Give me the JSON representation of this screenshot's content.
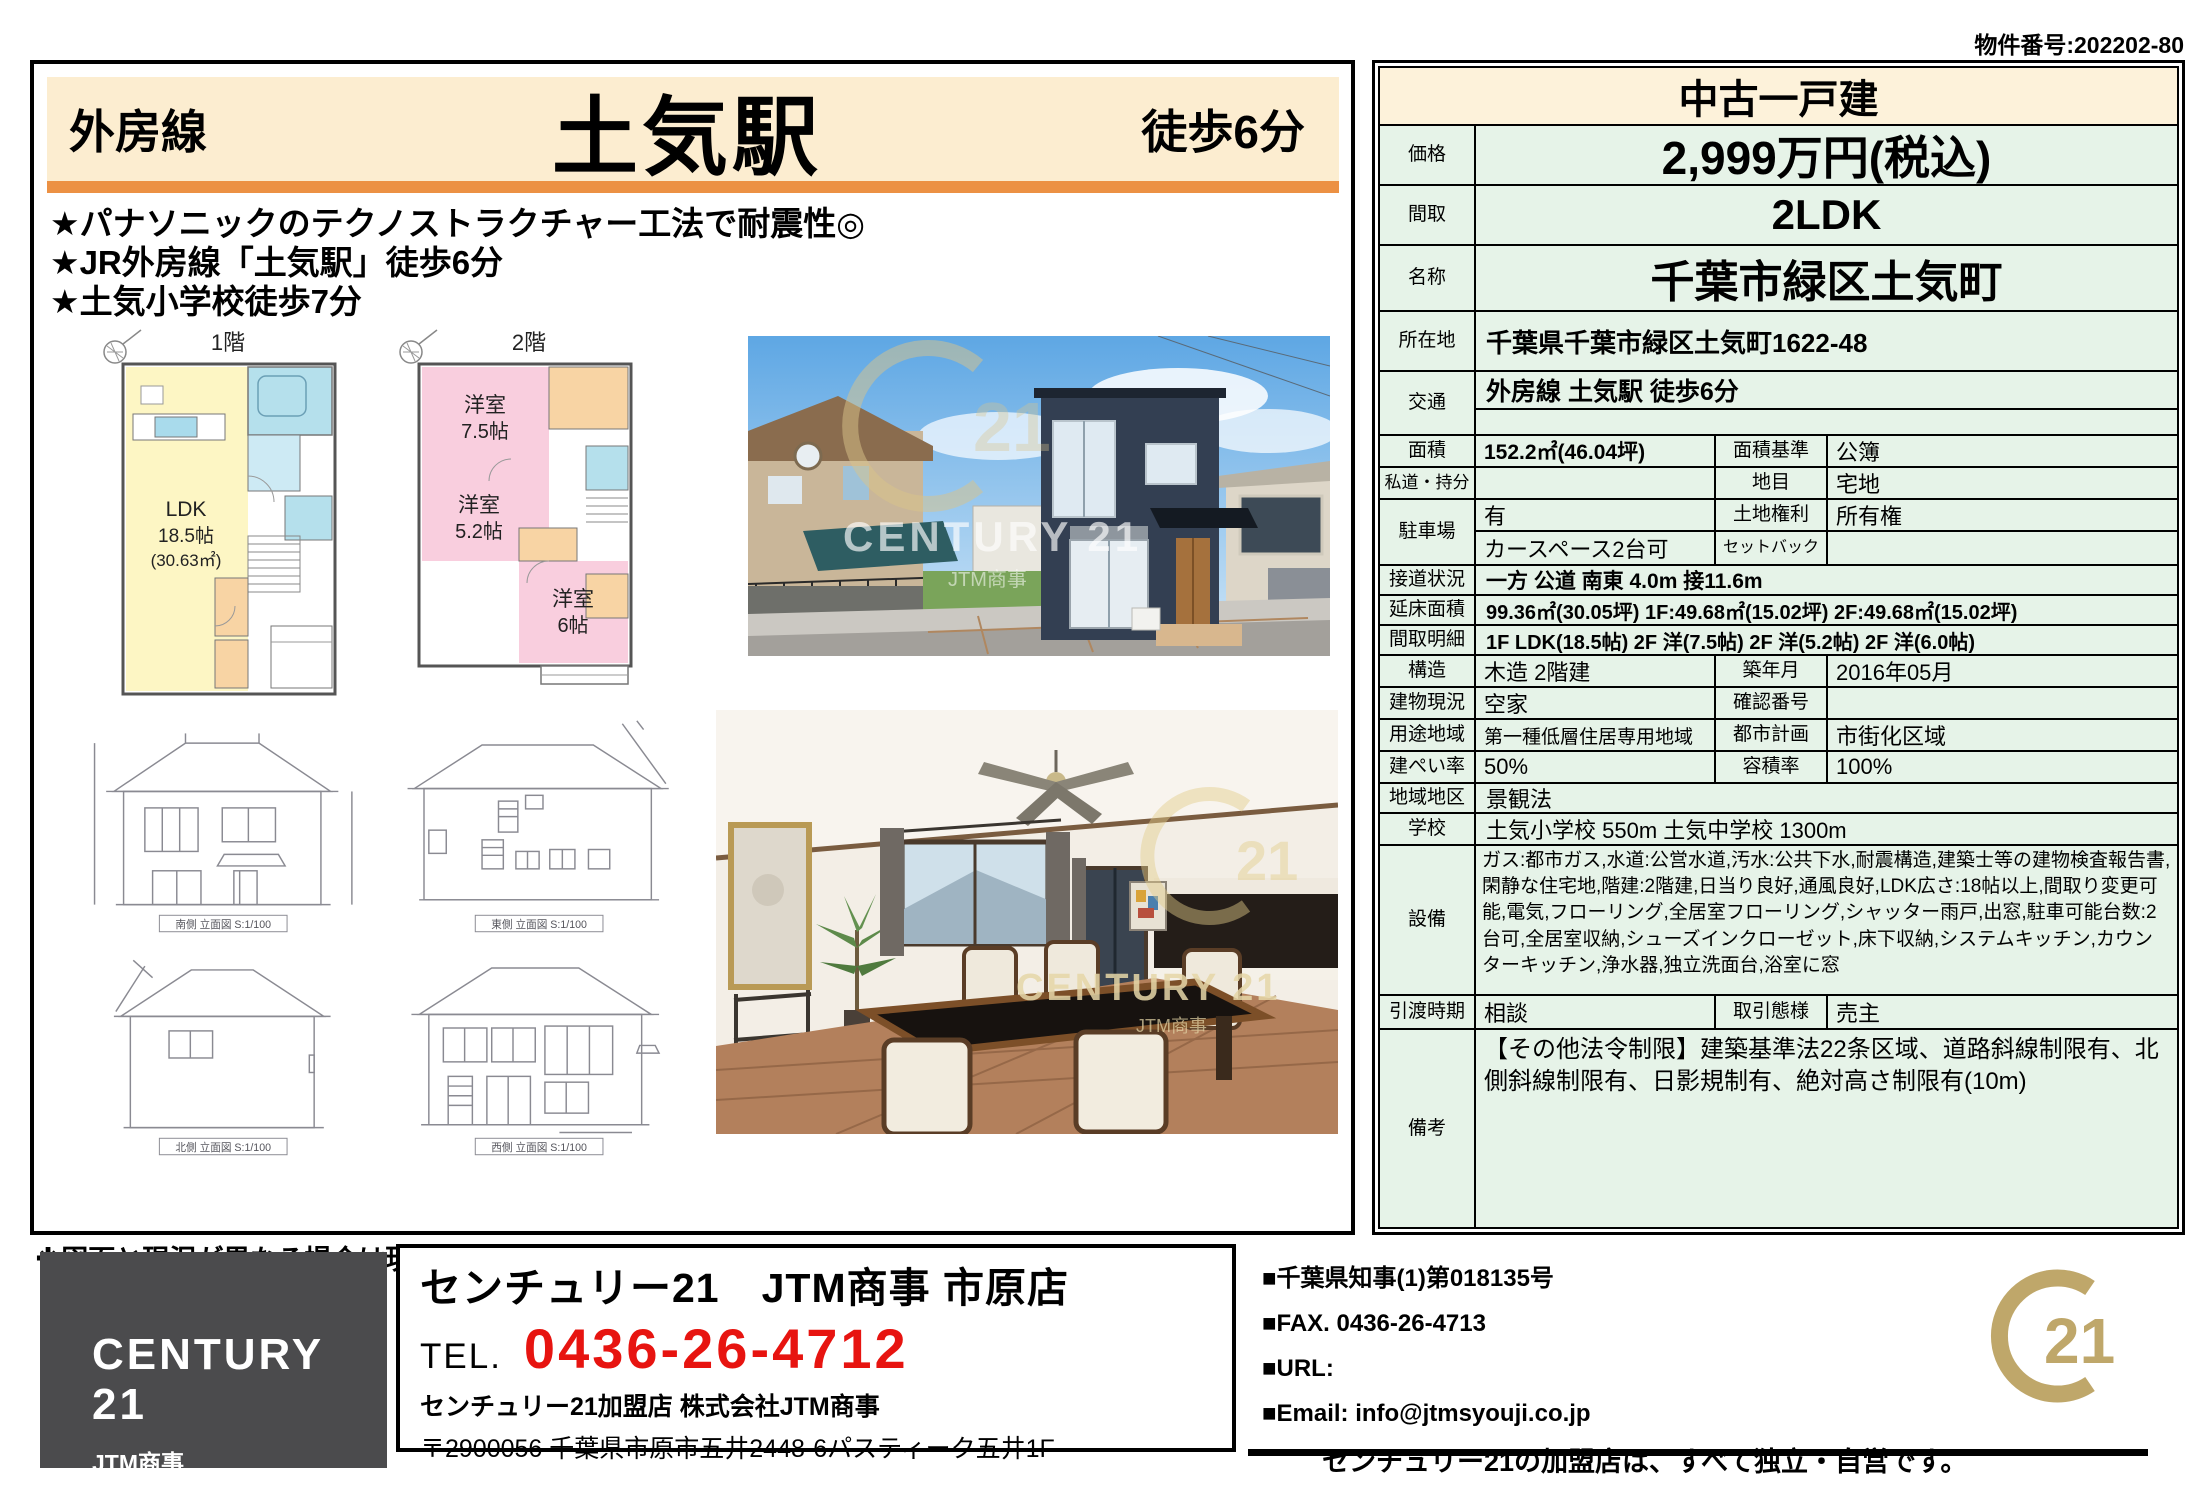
{
  "meta": {
    "property_number": "物件番号:202202-80"
  },
  "header": {
    "line_name": "外房線",
    "station": "土気駅",
    "walk_time": "徒歩6分"
  },
  "highlights": [
    "★パナソニックのテクノストラクチャー工法で耐震性◎",
    "★JR外房線「土気駅」徒歩6分",
    "★土気小学校徒歩7分"
  ],
  "floorplans": {
    "floor1_label": "1階",
    "floor2_label": "2階",
    "ldk_name": "LDK",
    "ldk_size": "18.5帖",
    "ldk_area": "(30.63㎡)",
    "room1_name": "洋室",
    "room1_size": "7.5帖",
    "room2_name": "洋室",
    "room2_size": "5.2帖",
    "room3_name": "洋室",
    "room3_size": "6帖"
  },
  "elevations": {
    "south": "南側 立面図 S:1/100",
    "east": "東側 立面図 S:1/100",
    "north": "北側 立面図 S:1/100",
    "west": "西側 立面図 S:1/100"
  },
  "photos": {
    "watermark": "CENTURY 21",
    "watermark_sub": "JTM商事"
  },
  "spec": {
    "title": "中古一戸建",
    "price": {
      "label": "価格",
      "value": "2,999万円(税込)"
    },
    "madori": {
      "label": "間取",
      "value": "2LDK"
    },
    "name": {
      "label": "名称",
      "value": "千葉市緑区土気町"
    },
    "location": {
      "label": "所在地",
      "value": "千葉県千葉市緑区土気町1622-48"
    },
    "access": {
      "label": "交通",
      "value": "外房線 土気駅 徒歩6分"
    },
    "area": {
      "label": "面積",
      "value": "152.2㎡(46.04坪)",
      "label2": "面積基準",
      "value2": "公簿"
    },
    "private_road": {
      "label": "私道・持分",
      "value": "",
      "label2": "地目",
      "value2": "宅地"
    },
    "parking": {
      "label": "駐車場",
      "value1": "有",
      "value2": "カースペース2台可",
      "label_r1": "土地権利",
      "value_r1": "所有権",
      "label_r2": "セットバック",
      "value_r2": ""
    },
    "road": {
      "label": "接道状況",
      "value": "一方 公道 南東 4.0m 接11.6m"
    },
    "floor_area": {
      "label": "延床面積",
      "value": "99.36㎡(30.05坪) 1F:49.68㎡(15.02坪) 2F:49.68㎡(15.02坪)"
    },
    "layout_detail": {
      "label": "間取明細",
      "value": "1F LDK(18.5帖) 2F 洋(7.5帖) 2F 洋(5.2帖) 2F 洋(6.0帖)"
    },
    "structure": {
      "label": "構造",
      "value": "木造 2階建",
      "label2": "築年月",
      "value2": "2016年05月"
    },
    "building_status": {
      "label": "建物現況",
      "value": "空家",
      "label2": "確認番号",
      "value2": ""
    },
    "zoning": {
      "label": "用途地域",
      "value": "第一種低層住居専用地域",
      "label2": "都市計画",
      "value2": "市街化区域"
    },
    "coverage": {
      "label": "建ぺい率",
      "value": "50%",
      "label2": "容積率",
      "value2": "100%"
    },
    "district": {
      "label": "地域地区",
      "value": "景観法"
    },
    "school": {
      "label": "学校",
      "value": "土気小学校 550m 土気中学校 1300m"
    },
    "equipment": {
      "label": "設備",
      "value": "ガス:都市ガス,水道:公営水道,汚水:公共下水,耐震構造,建築士等の建物検査報告書,閑静な住宅地,階建:2階建,日当り良好,通風良好,LDK広さ:18帖以上,間取り変更可能,電気,フローリング,全居室フローリング,シャッター雨戸,出窓,駐車可能台数:2台可,全居室収納,シューズインクローゼット,床下収納,システムキッチン,カウンターキッチン,浄水器,独立洗面台,浴室に窓"
    },
    "handover": {
      "label": "引渡時期",
      "value": "相談",
      "label2": "取引態様",
      "value2": "売主"
    },
    "remarks": {
      "label": "備考",
      "value": "【その他法令制限】建築基準法22条区域、道路斜線制限有、北側斜線制限有、日影規制有、絶対高さ制限有(10m)"
    }
  },
  "note": "※図面と現況が異なる場合は現況を優先させていただきます。",
  "footer": {
    "logo_title": "CENTURY 21",
    "logo_sub": "JTM商事",
    "office": "センチュリー21　JTM商事 市原店",
    "tel_label": "TEL.",
    "tel": "0436-26-4712",
    "member": "センチュリー21加盟店 株式会社JTM商事",
    "address": "〒2900056 千葉県市原市五井2448-6パスティーク五井1F",
    "license": "■千葉県知事(1)第018135号",
    "fax": "■FAX. 0436-26-4713",
    "url": "■URL:",
    "email": "■Email: info@jtmsyouji.co.jp",
    "independent": "センチュリー21の加盟店は、すべて独立・自営です。",
    "seal_number": "21"
  },
  "colors": {
    "accent_orange": "#ec9144",
    "header_cream": "#fcedd0",
    "table_green": "#e6f3e8",
    "title_cream": "#fdf2da",
    "tel_red": "#e71410",
    "century_gold": "#bfa76a",
    "logo_gray": "#4b4b4d"
  }
}
